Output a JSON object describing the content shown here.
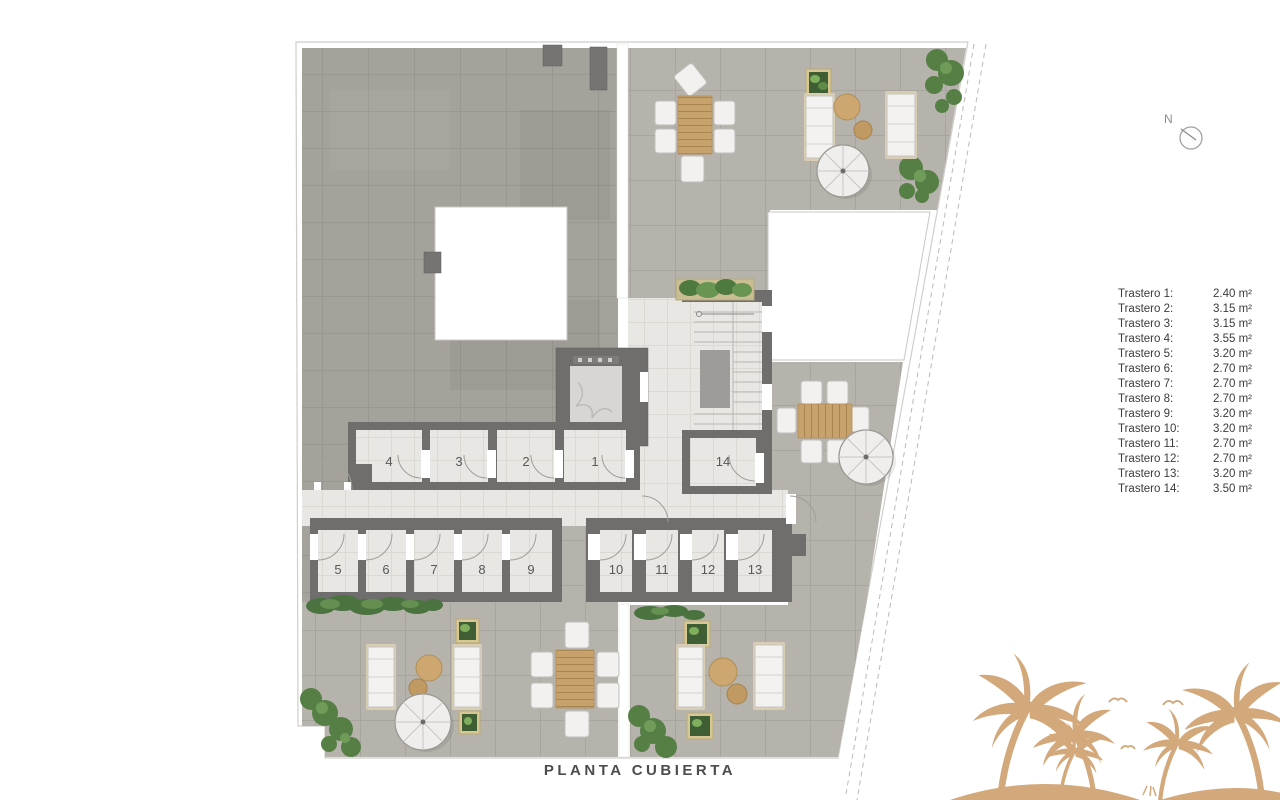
{
  "title": "PLANTA CUBIERTA",
  "north_label": "N",
  "legend": {
    "items": [
      {
        "label": "Trastero 1:",
        "value": "2.40 m²"
      },
      {
        "label": "Trastero 2:",
        "value": "3.15 m²"
      },
      {
        "label": "Trastero 3:",
        "value": "3.15 m²"
      },
      {
        "label": "Trastero 4:",
        "value": "3.55 m²"
      },
      {
        "label": "Trastero 5:",
        "value": "3.20 m²"
      },
      {
        "label": "Trastero 6:",
        "value": "2.70 m²"
      },
      {
        "label": "Trastero 7:",
        "value": "2.70 m²"
      },
      {
        "label": "Trastero 8:",
        "value": "2.70 m²"
      },
      {
        "label": "Trastero 9:",
        "value": "3.20 m²"
      },
      {
        "label": "Trastero 10:",
        "value": "3.20 m²"
      },
      {
        "label": "Trastero 11:",
        "value": "2.70 m²"
      },
      {
        "label": "Trastero 12:",
        "value": "2.70 m²"
      },
      {
        "label": "Trastero 13:",
        "value": "3.20 m²"
      },
      {
        "label": "Trastero 14:",
        "value": "3.50 m²"
      }
    ]
  },
  "plan": {
    "room_labels": [
      "1",
      "2",
      "3",
      "4",
      "5",
      "6",
      "7",
      "8",
      "9",
      "10",
      "11",
      "12",
      "13",
      "14"
    ]
  },
  "icons": {
    "north_indicator": "compass-circle-with-needle",
    "decoration": "palm-trees-and-seagulls"
  },
  "colors": {
    "roof_tile": "#a5a19b",
    "terrace_tile": "#b6b2ac",
    "storage_floor": "#e8e7e4",
    "wall": "#6f6e6c",
    "wood": "#c7a26d",
    "plant_green": "#567f46",
    "palm_decoration": "#d3a87a",
    "text": "#3b3b3b"
  }
}
